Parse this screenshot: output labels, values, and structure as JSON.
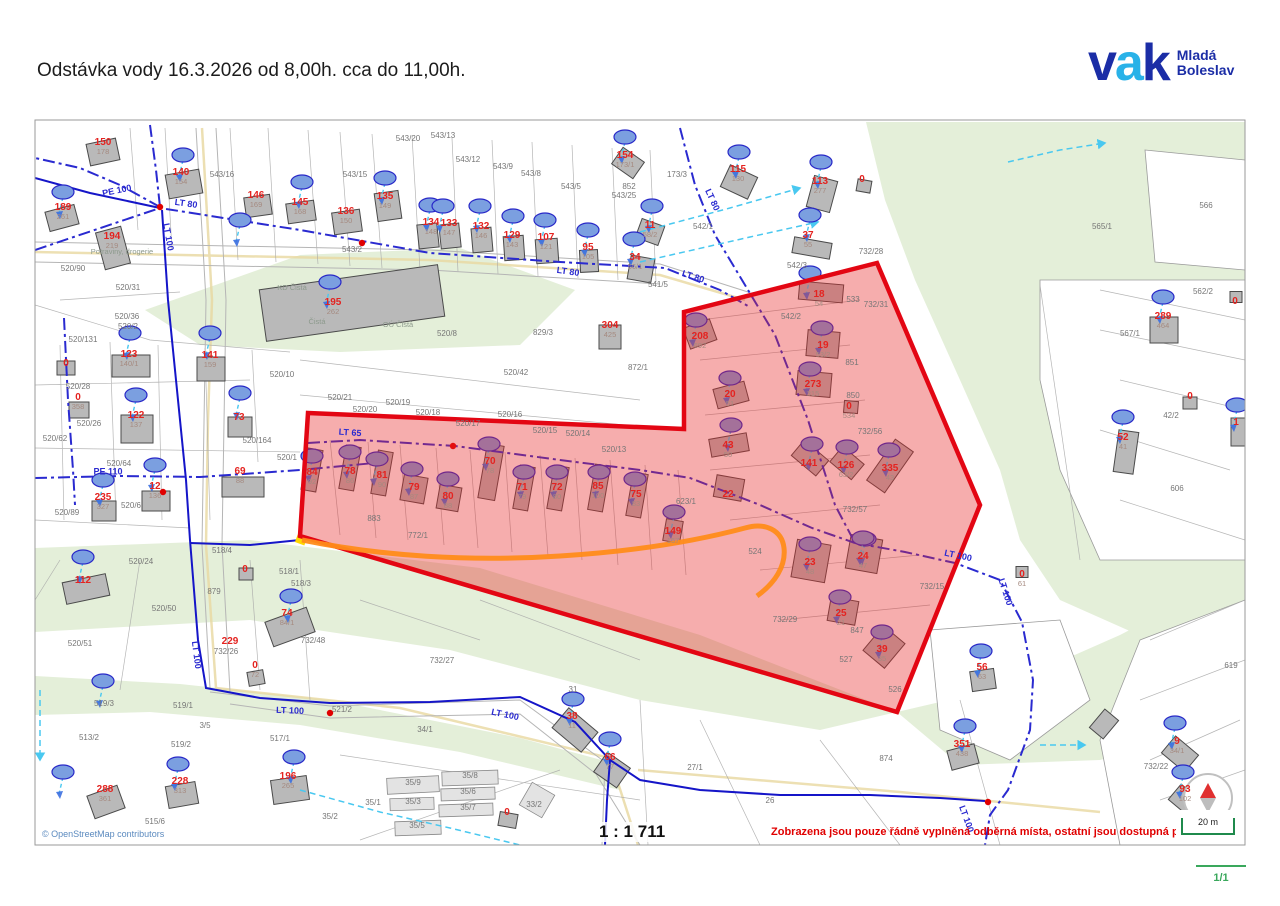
{
  "header": {
    "title": "Odstávka vody 16.3.2026  od 8,00h. cca do 11,00h."
  },
  "logo": {
    "letter_v": "v",
    "letter_a": "a",
    "letter_k": "k",
    "subtitle_line1": "Mladá",
    "subtitle_line2": "Boleslav",
    "color_dark": "#1b2da6",
    "color_light": "#29b2e8"
  },
  "map": {
    "copyright": "© OpenStreetMap contributors",
    "scale_text": "1 : 1 711",
    "notice_text": "Zobrazena jsou pouze řádně vyplněná odběrná místa, ostatní jsou dostupná p",
    "scale_bar_label": "20 m",
    "page_indicator": "1/1",
    "colors": {
      "outage_fill": "rgba(232,40,40,0.38)",
      "outage_stroke": "#e30613",
      "pipe_main": "#1515c8",
      "pipe_dashdot": "#2a2ad0",
      "service_line": "#49c8f0",
      "road_orange": "#ff8c1a",
      "house_number_red": "#e42320",
      "parcel_gray": "#767676",
      "green_area": "#e4efd9",
      "accent_green": "#3aa85c"
    },
    "symbols": {
      "water_meter": "blue-ellipse",
      "valve": "red-dot",
      "north_arrow": "compass"
    },
    "labels": {
      "red": [
        {
          "t": "150",
          "b": "178",
          "x": 103,
          "y": 147
        },
        {
          "t": "140",
          "b": "154",
          "x": 181,
          "y": 177
        },
        {
          "t": "189",
          "b": "261",
          "x": 63,
          "y": 212
        },
        {
          "t": "194",
          "b": "219",
          "x": 112,
          "y": 241
        },
        {
          "t": "146",
          "b": "169",
          "x": 256,
          "y": 200
        },
        {
          "t": "145",
          "b": "168",
          "x": 300,
          "y": 207
        },
        {
          "t": "135",
          "b": "149",
          "x": 385,
          "y": 201
        },
        {
          "t": "136",
          "b": "150",
          "x": 346,
          "y": 216
        },
        {
          "t": "134",
          "b": "148",
          "x": 431,
          "y": 227
        },
        {
          "t": "133",
          "b": "147",
          "x": 449,
          "y": 228
        },
        {
          "t": "132",
          "b": "146",
          "x": 481,
          "y": 231
        },
        {
          "t": "129",
          "b": "143",
          "x": 512,
          "y": 240
        },
        {
          "t": "107",
          "b": "121",
          "x": 546,
          "y": 242
        },
        {
          "t": "95",
          "b": "105",
          "x": 588,
          "y": 252
        },
        {
          "t": "11",
          "b": "58/2",
          "x": 650,
          "y": 230
        },
        {
          "t": "34",
          "b": "56/1",
          "x": 635,
          "y": 262
        },
        {
          "t": "154",
          "b": "173/1",
          "x": 625,
          "y": 160
        },
        {
          "t": "115",
          "b": "130",
          "x": 738,
          "y": 174
        },
        {
          "t": "113",
          "b": "277",
          "x": 820,
          "y": 186
        },
        {
          "t": "0",
          "b": "",
          "x": 862,
          "y": 180
        },
        {
          "t": "37",
          "b": "55",
          "x": 808,
          "y": 240
        },
        {
          "t": "195",
          "b": "262",
          "x": 333,
          "y": 307
        },
        {
          "t": "304",
          "b": "425",
          "x": 610,
          "y": 330
        },
        {
          "t": "123",
          "b": "140/1",
          "x": 129,
          "y": 359
        },
        {
          "t": "141",
          "b": "159",
          "x": 210,
          "y": 360
        },
        {
          "t": "0",
          "b": "",
          "x": 66,
          "y": 364
        },
        {
          "t": "0",
          "b": "358",
          "x": 78,
          "y": 402
        },
        {
          "t": "122",
          "b": "137",
          "x": 136,
          "y": 420
        },
        {
          "t": "73",
          "b": "",
          "x": 239,
          "y": 418
        },
        {
          "t": "235",
          "b": "327",
          "x": 103,
          "y": 502
        },
        {
          "t": "12",
          "b": "136",
          "x": 155,
          "y": 491
        },
        {
          "t": "69",
          "b": "88",
          "x": 240,
          "y": 476
        },
        {
          "t": "112",
          "b": "",
          "x": 83,
          "y": 581
        },
        {
          "t": "0",
          "b": "",
          "x": 245,
          "y": 570
        },
        {
          "t": "74",
          "b": "84/1",
          "x": 287,
          "y": 618
        },
        {
          "t": "229",
          "b": "",
          "x": 230,
          "y": 642
        },
        {
          "t": "0",
          "b": "72",
          "x": 255,
          "y": 670
        },
        {
          "t": "288",
          "b": "361",
          "x": 105,
          "y": 794
        },
        {
          "t": "228",
          "b": "313",
          "x": 180,
          "y": 786
        },
        {
          "t": "196",
          "b": "265",
          "x": 288,
          "y": 781
        },
        {
          "t": "38",
          "b": "11",
          "x": 572,
          "y": 721
        },
        {
          "t": "66",
          "b": "77",
          "x": 610,
          "y": 762
        },
        {
          "t": "0",
          "b": "",
          "x": 507,
          "y": 813
        },
        {
          "t": "84",
          "b": "92",
          "x": 312,
          "y": 477
        },
        {
          "t": "78",
          "b": "86",
          "x": 350,
          "y": 476
        },
        {
          "t": "81",
          "b": "90",
          "x": 382,
          "y": 480
        },
        {
          "t": "79",
          "b": "87",
          "x": 414,
          "y": 492
        },
        {
          "t": "80",
          "b": "88",
          "x": 448,
          "y": 501
        },
        {
          "t": "70",
          "b": "78",
          "x": 490,
          "y": 466
        },
        {
          "t": "71",
          "b": "79",
          "x": 522,
          "y": 492
        },
        {
          "t": "72",
          "b": "80",
          "x": 557,
          "y": 492
        },
        {
          "t": "85",
          "b": "100",
          "x": 598,
          "y": 491
        },
        {
          "t": "75",
          "b": "83",
          "x": 636,
          "y": 499
        },
        {
          "t": "149",
          "b": "167",
          "x": 673,
          "y": 536
        },
        {
          "t": "208",
          "b": "692",
          "x": 700,
          "y": 341
        },
        {
          "t": "18",
          "b": "54",
          "x": 819,
          "y": 299
        },
        {
          "t": "19",
          "b": "53/2",
          "x": 823,
          "y": 350
        },
        {
          "t": "20",
          "b": "51",
          "x": 730,
          "y": 399
        },
        {
          "t": "273",
          "b": "315",
          "x": 813,
          "y": 389
        },
        {
          "t": "0",
          "b": "534",
          "x": 849,
          "y": 411
        },
        {
          "t": "43",
          "b": "50",
          "x": 728,
          "y": 450
        },
        {
          "t": "141",
          "b": "",
          "x": 809,
          "y": 464
        },
        {
          "t": "126",
          "b": "63/2",
          "x": 846,
          "y": 470
        },
        {
          "t": "335",
          "b": "43",
          "x": 890,
          "y": 473
        },
        {
          "t": "22",
          "b": "",
          "x": 728,
          "y": 495
        },
        {
          "t": "23",
          "b": "48",
          "x": 810,
          "y": 567
        },
        {
          "t": "24",
          "b": "47",
          "x": 863,
          "y": 561
        },
        {
          "t": "25",
          "b": "21",
          "x": 841,
          "y": 618
        },
        {
          "t": "39",
          "b": "35",
          "x": 882,
          "y": 654
        },
        {
          "t": "0",
          "b": "61",
          "x": 1022,
          "y": 579
        },
        {
          "t": "56",
          "b": "63",
          "x": 982,
          "y": 672
        },
        {
          "t": "351",
          "b": "438",
          "x": 962,
          "y": 749
        },
        {
          "t": "9",
          "b": "34/1",
          "x": 1177,
          "y": 746
        },
        {
          "t": "93",
          "b": "102",
          "x": 1185,
          "y": 794
        },
        {
          "t": "289",
          "b": "464",
          "x": 1163,
          "y": 321
        },
        {
          "t": "52",
          "b": "41",
          "x": 1123,
          "y": 442
        },
        {
          "t": "1",
          "b": "",
          "x": 1236,
          "y": 423
        },
        {
          "t": "0",
          "b": "",
          "x": 1235,
          "y": 302
        },
        {
          "t": "0",
          "b": "",
          "x": 1190,
          "y": 397
        }
      ],
      "gray": [
        {
          "t": "543/16",
          "x": 222,
          "y": 175
        },
        {
          "t": "543/20",
          "x": 408,
          "y": 139
        },
        {
          "t": "543/13",
          "x": 443,
          "y": 136
        },
        {
          "t": "543/15",
          "x": 355,
          "y": 175
        },
        {
          "t": "543/12",
          "x": 468,
          "y": 160
        },
        {
          "t": "543/9",
          "x": 503,
          "y": 167
        },
        {
          "t": "543/8",
          "x": 531,
          "y": 174
        },
        {
          "t": "543/5",
          "x": 571,
          "y": 187
        },
        {
          "t": "543/25",
          "x": 624,
          "y": 196
        },
        {
          "t": "543/2",
          "x": 352,
          "y": 250
        },
        {
          "t": "852",
          "x": 629,
          "y": 187
        },
        {
          "t": "173/3",
          "x": 677,
          "y": 175
        },
        {
          "t": "541/5",
          "x": 658,
          "y": 285
        },
        {
          "t": "520/90",
          "x": 73,
          "y": 269
        },
        {
          "t": "520/31",
          "x": 128,
          "y": 288
        },
        {
          "t": "520/36",
          "x": 127,
          "y": 317
        },
        {
          "t": "520/2",
          "x": 128,
          "y": 327
        },
        {
          "t": "520/131",
          "x": 83,
          "y": 340
        },
        {
          "t": "520/28",
          "x": 78,
          "y": 387
        },
        {
          "t": "520/26",
          "x": 89,
          "y": 424
        },
        {
          "t": "520/62",
          "x": 55,
          "y": 439
        },
        {
          "t": "520/64",
          "x": 119,
          "y": 464
        },
        {
          "t": "520/164",
          "x": 257,
          "y": 441
        },
        {
          "t": "520/6",
          "x": 131,
          "y": 506
        },
        {
          "t": "520/89",
          "x": 67,
          "y": 513
        },
        {
          "t": "520/1",
          "x": 287,
          "y": 458
        },
        {
          "t": "520/10",
          "x": 282,
          "y": 375
        },
        {
          "t": "520/21",
          "x": 340,
          "y": 398
        },
        {
          "t": "520/19",
          "x": 398,
          "y": 403
        },
        {
          "t": "520/20",
          "x": 365,
          "y": 410
        },
        {
          "t": "520/18",
          "x": 428,
          "y": 413
        },
        {
          "t": "520/17",
          "x": 468,
          "y": 424
        },
        {
          "t": "520/16",
          "x": 510,
          "y": 415
        },
        {
          "t": "520/15",
          "x": 545,
          "y": 431
        },
        {
          "t": "520/14",
          "x": 578,
          "y": 434
        },
        {
          "t": "520/13",
          "x": 614,
          "y": 450
        },
        {
          "t": "520/8",
          "x": 447,
          "y": 334
        },
        {
          "t": "829/3",
          "x": 543,
          "y": 333
        },
        {
          "t": "520/42",
          "x": 516,
          "y": 373
        },
        {
          "t": "872/1",
          "x": 638,
          "y": 368
        },
        {
          "t": "542/2",
          "x": 791,
          "y": 317
        },
        {
          "t": "542/3",
          "x": 797,
          "y": 266
        },
        {
          "t": "542/1",
          "x": 703,
          "y": 227
        },
        {
          "t": "533",
          "x": 853,
          "y": 300
        },
        {
          "t": "732/31",
          "x": 876,
          "y": 305
        },
        {
          "t": "732/28",
          "x": 871,
          "y": 252
        },
        {
          "t": "851",
          "x": 852,
          "y": 363
        },
        {
          "t": "850",
          "x": 853,
          "y": 396
        },
        {
          "t": "732/56",
          "x": 870,
          "y": 432
        },
        {
          "t": "732/57",
          "x": 855,
          "y": 510
        },
        {
          "t": "524",
          "x": 755,
          "y": 552
        },
        {
          "t": "732/15",
          "x": 932,
          "y": 587
        },
        {
          "t": "732/29",
          "x": 785,
          "y": 620
        },
        {
          "t": "847",
          "x": 857,
          "y": 631
        },
        {
          "t": "527",
          "x": 846,
          "y": 660
        },
        {
          "t": "526",
          "x": 895,
          "y": 690
        },
        {
          "t": "623/1",
          "x": 686,
          "y": 502
        },
        {
          "t": "883",
          "x": 374,
          "y": 519
        },
        {
          "t": "772/1",
          "x": 418,
          "y": 536
        },
        {
          "t": "520/24",
          "x": 141,
          "y": 562
        },
        {
          "t": "520/50",
          "x": 164,
          "y": 609
        },
        {
          "t": "520/51",
          "x": 80,
          "y": 644
        },
        {
          "t": "518/4",
          "x": 222,
          "y": 551
        },
        {
          "t": "518/1",
          "x": 289,
          "y": 572
        },
        {
          "t": "518/3",
          "x": 301,
          "y": 584
        },
        {
          "t": "879",
          "x": 214,
          "y": 592
        },
        {
          "t": "732/48",
          "x": 313,
          "y": 641
        },
        {
          "t": "732/26",
          "x": 226,
          "y": 652
        },
        {
          "t": "519/3",
          "x": 104,
          "y": 704
        },
        {
          "t": "513/2",
          "x": 89,
          "y": 738
        },
        {
          "t": "519/2",
          "x": 181,
          "y": 745
        },
        {
          "t": "517/1",
          "x": 280,
          "y": 739
        },
        {
          "t": "519/1",
          "x": 183,
          "y": 706
        },
        {
          "t": "3/5",
          "x": 205,
          "y": 726
        },
        {
          "t": "521/2",
          "x": 342,
          "y": 710
        },
        {
          "t": "34/1",
          "x": 425,
          "y": 730
        },
        {
          "t": "732/27",
          "x": 442,
          "y": 661
        },
        {
          "t": "31",
          "x": 573,
          "y": 690
        },
        {
          "t": "27/1",
          "x": 695,
          "y": 768
        },
        {
          "t": "26",
          "x": 770,
          "y": 801
        },
        {
          "t": "874",
          "x": 886,
          "y": 759
        },
        {
          "t": "35/1",
          "x": 373,
          "y": 803
        },
        {
          "t": "35/2",
          "x": 330,
          "y": 817
        },
        {
          "t": "35/3",
          "x": 413,
          "y": 802
        },
        {
          "t": "35/5",
          "x": 417,
          "y": 826
        },
        {
          "t": "35/6",
          "x": 468,
          "y": 792
        },
        {
          "t": "35/7",
          "x": 468,
          "y": 808
        },
        {
          "t": "35/8",
          "x": 470,
          "y": 776
        },
        {
          "t": "35/9",
          "x": 413,
          "y": 783
        },
        {
          "t": "33/2",
          "x": 534,
          "y": 805
        },
        {
          "t": "515/6",
          "x": 155,
          "y": 822
        },
        {
          "t": "562/2",
          "x": 1203,
          "y": 292
        },
        {
          "t": "567/1",
          "x": 1130,
          "y": 334
        },
        {
          "t": "42/2",
          "x": 1171,
          "y": 416
        },
        {
          "t": "606",
          "x": 1177,
          "y": 489
        },
        {
          "t": "566",
          "x": 1206,
          "y": 206
        },
        {
          "t": "565/1",
          "x": 1102,
          "y": 227
        },
        {
          "t": "619",
          "x": 1231,
          "y": 666
        },
        {
          "t": "732/22",
          "x": 1156,
          "y": 767
        }
      ],
      "pipe": [
        {
          "t": "LT 80",
          "x": 186,
          "y": 204,
          "r": 8
        },
        {
          "t": "LT 80",
          "x": 568,
          "y": 272,
          "r": 8
        },
        {
          "t": "LT 80",
          "x": 712,
          "y": 200,
          "r": 65
        },
        {
          "t": "LT 80",
          "x": 693,
          "y": 277,
          "r": 18
        },
        {
          "t": "LT 65",
          "x": 350,
          "y": 433,
          "r": 4
        },
        {
          "t": "LT 100",
          "x": 168,
          "y": 237,
          "r": 80
        },
        {
          "t": "LT 100",
          "x": 196,
          "y": 655,
          "r": 83
        },
        {
          "t": "LT 100",
          "x": 290,
          "y": 711,
          "r": 2
        },
        {
          "t": "LT 100",
          "x": 505,
          "y": 715,
          "r": 12
        },
        {
          "t": "LT 100",
          "x": 958,
          "y": 556,
          "r": 12
        },
        {
          "t": "LT 100",
          "x": 1005,
          "y": 592,
          "r": 72
        },
        {
          "t": "LT 100",
          "x": 966,
          "y": 819,
          "r": 70
        },
        {
          "t": "PE 110",
          "x": 108,
          "y": 472,
          "r": 0
        },
        {
          "t": "PE 100",
          "x": 117,
          "y": 191,
          "r": -12
        }
      ],
      "poi": [
        {
          "t": "KD Čistá",
          "x": 292,
          "y": 288
        },
        {
          "t": "Čistá",
          "x": 317,
          "y": 322
        },
        {
          "t": "OÚ Čistá",
          "x": 398,
          "y": 325
        },
        {
          "t": "Potraviny, drogerie",
          "x": 122,
          "y": 252
        }
      ]
    }
  }
}
